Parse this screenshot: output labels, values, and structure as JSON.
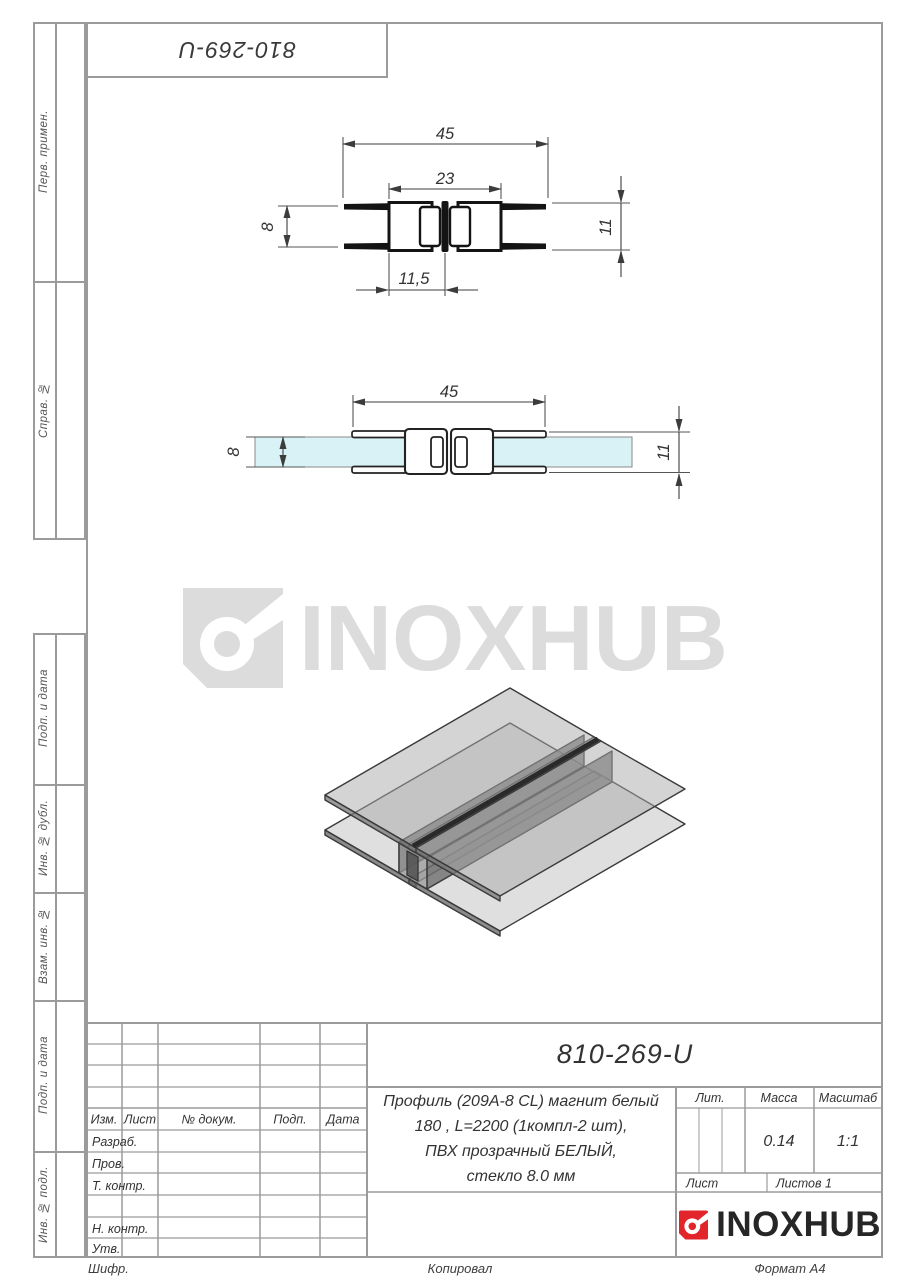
{
  "top_box": {
    "number": "810-269-U"
  },
  "sidebar": {
    "labels": [
      "Перв. примен.",
      "Справ. №",
      "Подп. и дата",
      "Инв. № дубл.",
      "Взам. инв. №",
      "Подп. и дата",
      "Инв. № подл."
    ]
  },
  "watermark": {
    "text": "INOXHUB"
  },
  "drawing1": {
    "dims": {
      "width": "45",
      "inner": "23",
      "glass": "8",
      "height": "11",
      "offset": "11,5"
    }
  },
  "drawing2": {
    "dims": {
      "width": "45",
      "glass": "8",
      "height": "11"
    }
  },
  "title_block": {
    "doc_number": "810-269-U",
    "description_lines": [
      "Профиль (209А-8 CL) магнит белый",
      "180 , L=2200 (1компл-2 шт),",
      "ПВХ прозрачный БЕЛЫЙ,",
      "стекло 8.0 мм"
    ],
    "headers": {
      "izm": "Изм.",
      "list": "Лист",
      "doc": "№ докум.",
      "podp": "Подп.",
      "data": "Дата"
    },
    "rows": {
      "razrab": "Разраб.",
      "prov": "Пров.",
      "tkontr": "Т. контр.",
      "nkontr": "Н. контр.",
      "utv": "Утв."
    },
    "lit_label": "Лит.",
    "massa_label": "Масса",
    "masshtab_label": "Масштаб",
    "massa_value": "0.14",
    "masshtab_value": "1:1",
    "list_label": "Лист",
    "listov_label": "Листов 1",
    "logo_text": "INOXHUB"
  },
  "footer": {
    "cipher": "Шифр.",
    "copied": "Копировал",
    "format": "Формат А4"
  },
  "colors": {
    "glass": "#d9f2f5",
    "logo_red": "#e2252b",
    "watermark_gray": "#dcdcdc",
    "line_dark": "#1a1a1a"
  }
}
